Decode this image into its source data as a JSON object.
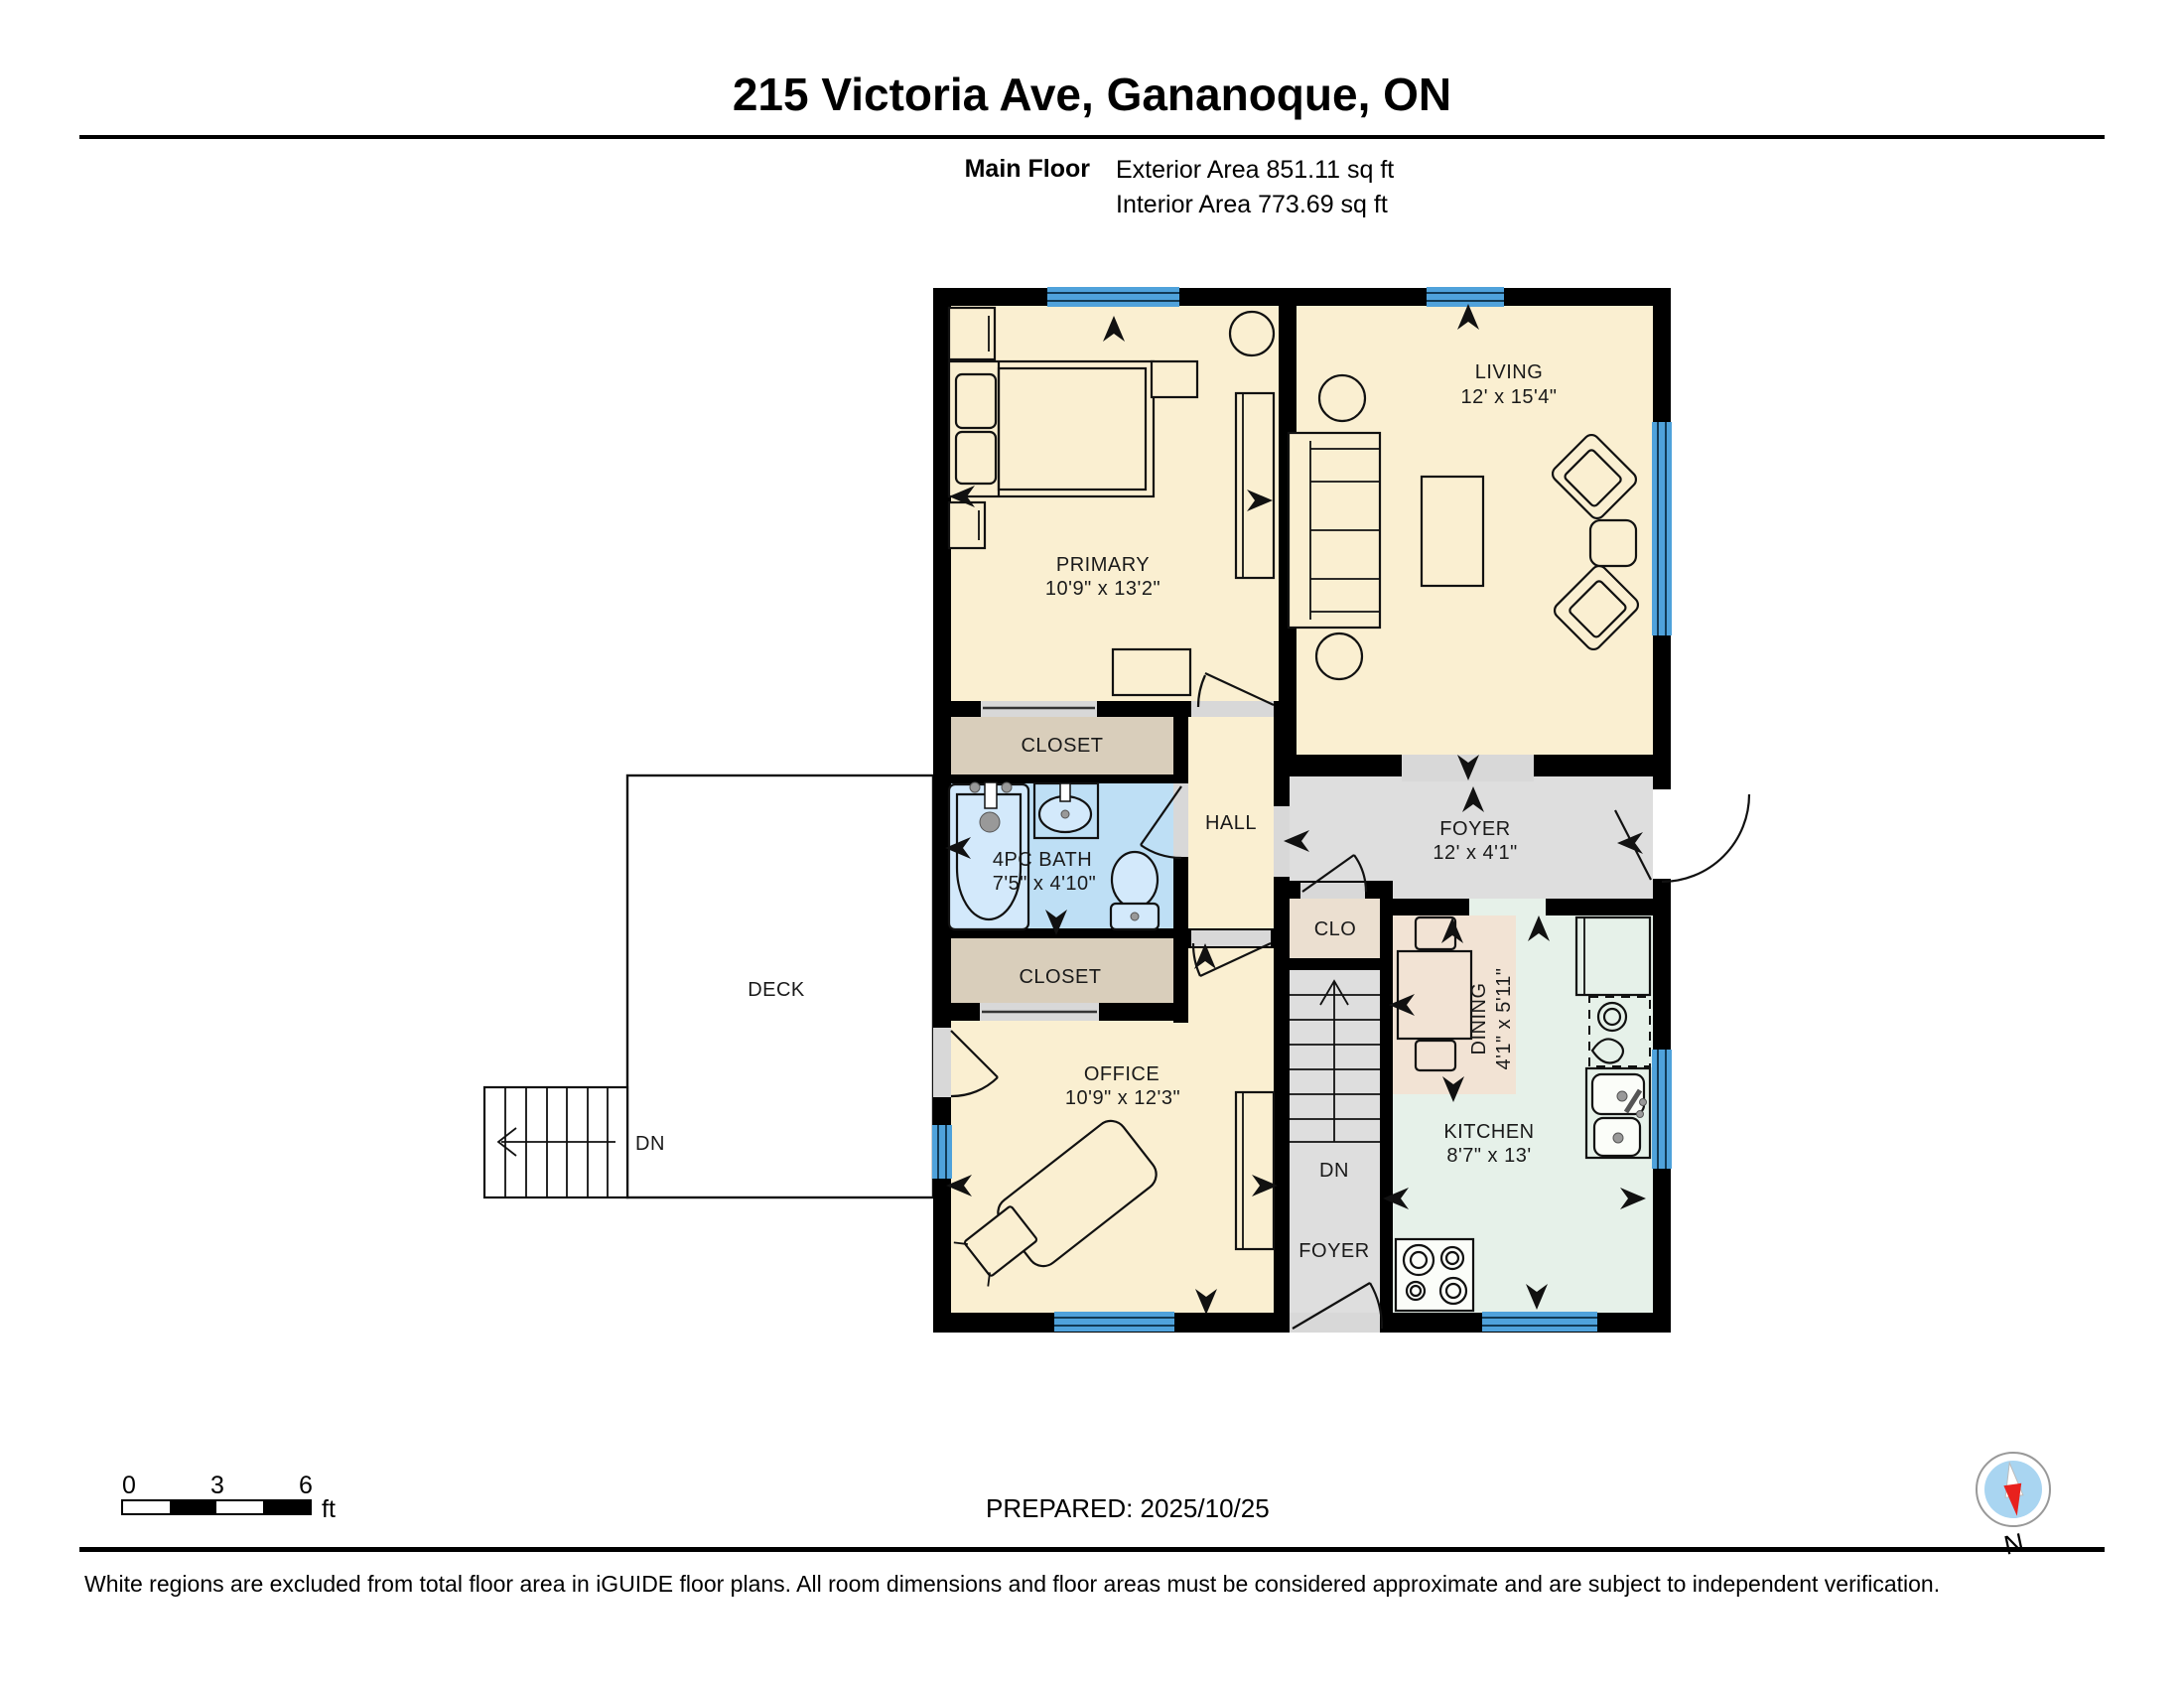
{
  "header": {
    "title": "215 Victoria Ave, Gananoque, ON",
    "floor_label": "Main Floor",
    "exterior_area": "Exterior Area 851.11 sq ft",
    "interior_area": "Interior Area 773.69 sq ft"
  },
  "rooms": {
    "primary": {
      "name": "PRIMARY",
      "dims": "10'9\" x 13'2\""
    },
    "living": {
      "name": "LIVING",
      "dims": "12' x 15'4\""
    },
    "closet_upper": {
      "name": "CLOSET"
    },
    "bath": {
      "name": "4PC BATH",
      "dims": "7'5\" x 4'10\""
    },
    "hall": {
      "name": "HALL"
    },
    "closet_lower": {
      "name": "CLOSET"
    },
    "foyer": {
      "name": "FOYER",
      "dims": "12' x 4'1\""
    },
    "clo": {
      "name": "CLO"
    },
    "dining": {
      "name": "DINING",
      "dims": "4'1\" x 5'11\""
    },
    "kitchen": {
      "name": "KITCHEN",
      "dims": "8'7\" x 13'"
    },
    "office": {
      "name": "OFFICE",
      "dims": "10'9\" x 12'3\""
    },
    "deck": {
      "name": "DECK"
    },
    "basement_stairs": {
      "dn": "DN",
      "foyer": "FOYER"
    },
    "deck_stairs": {
      "dn": "DN"
    }
  },
  "scale_bar": {
    "ticks": [
      "0",
      "3",
      "6"
    ],
    "unit": "ft"
  },
  "compass": {
    "label": "N"
  },
  "footer": {
    "prepared": "PREPARED: 2025/10/25",
    "disclaimer": "White regions are excluded from total floor area in iGUIDE floor plans. All room dimensions and floor areas must be considered approximate and are subject to independent verification."
  },
  "colors": {
    "wall": "#000000",
    "floor_cream": "#FAEFD1",
    "closet_tan": "#D9CEBB",
    "bath_blue": "#BEDFF5",
    "foyer_gray": "#DEDEDE",
    "clo_beige": "#EBDFD0",
    "dining_tan": "#F2E3D4",
    "kitchen_mint": "#E6F1E9",
    "window_blue": "#4FA2DB",
    "compass_red": "#E8211D",
    "compass_blue": "#A9D5F1"
  }
}
